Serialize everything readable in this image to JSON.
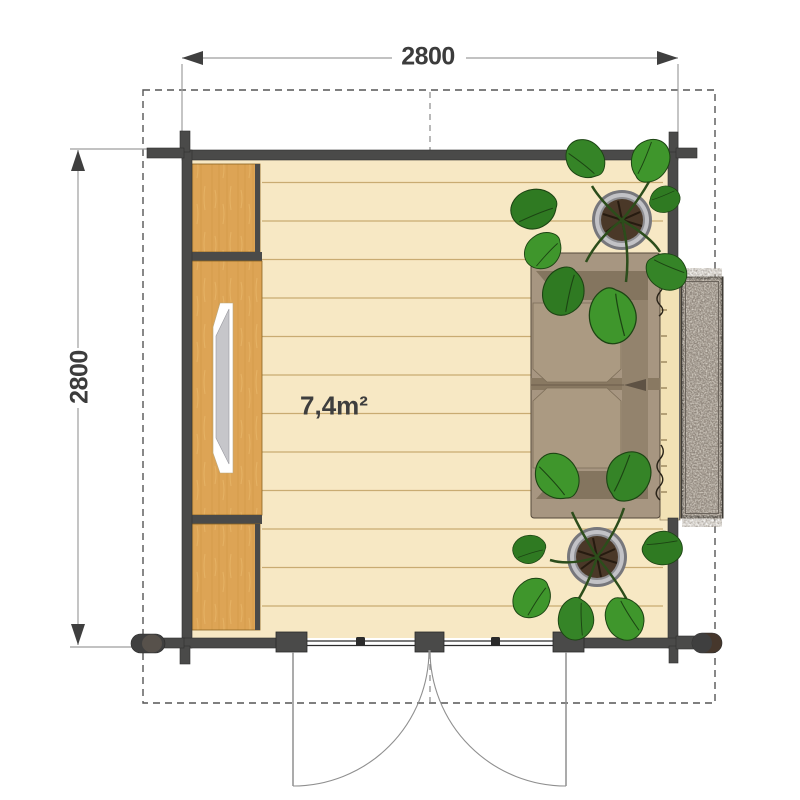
{
  "floor_plan": {
    "labels": {
      "width_dimension": "2800",
      "depth_dimension": "2800",
      "floor_area": "7,4m²"
    },
    "colors": {
      "wall": "#4a4a49",
      "floor": "#f7e8c4",
      "plank_line": "#c9ab72",
      "cabinet_wood": "#dda455",
      "window_pane": "#c6c6ca",
      "sofa_base": "#a79681",
      "sofa_shadow": "#7e6f5a",
      "plant_leaf": "#3f962c",
      "plant_leaf_dark": "#2f7a22",
      "pot_soil": "#4a3828",
      "granite": "#9a9085",
      "dimension_text": "#3c3c3c",
      "dimension_line": "#9e9e9e",
      "door_arc": "#8f8f8f",
      "overhang_dash": "#555555"
    }
  }
}
